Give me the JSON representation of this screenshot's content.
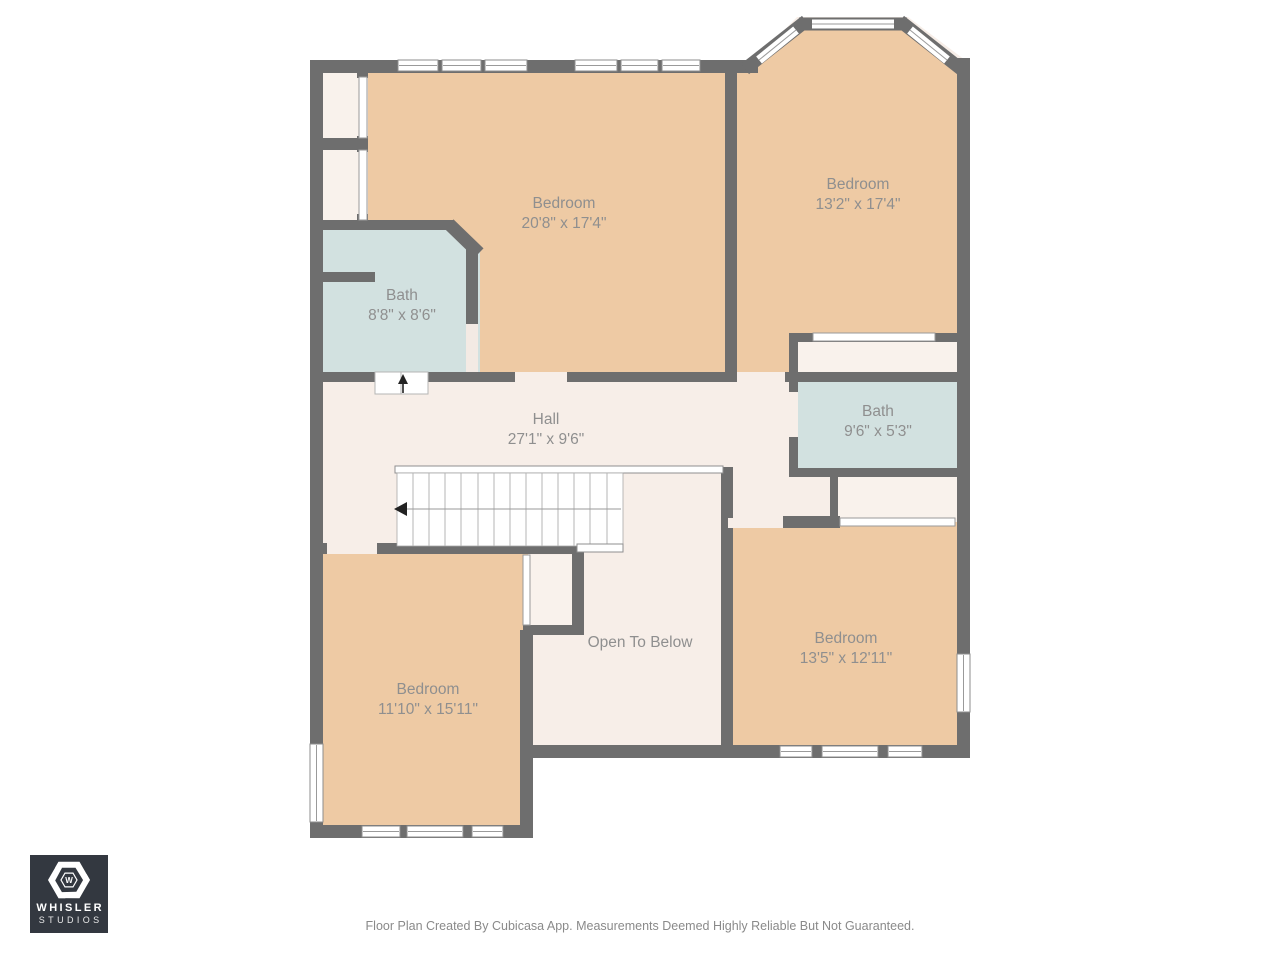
{
  "plan": {
    "rooms": [
      {
        "id": "bedroom-1",
        "label": "Bedroom",
        "dims": "20'8\" x 17'4\""
      },
      {
        "id": "bedroom-2",
        "label": "Bedroom",
        "dims": "13'2\" x 17'4\""
      },
      {
        "id": "bath-1",
        "label": "Bath",
        "dims": "8'8\" x 8'6\""
      },
      {
        "id": "hall",
        "label": "Hall",
        "dims": "27'1\" x 9'6\""
      },
      {
        "id": "bath-2",
        "label": "Bath",
        "dims": "9'6\" x 5'3\""
      },
      {
        "id": "open-to-below",
        "label": "Open To Below",
        "dims": ""
      },
      {
        "id": "bedroom-3",
        "label": "Bedroom",
        "dims": "13'5\" x 12'11\""
      },
      {
        "id": "bedroom-4",
        "label": "Bedroom",
        "dims": "11'10\" x 15'11\""
      }
    ],
    "colors": {
      "wall": "#6e6e6e",
      "bedroom_fill": "#eecaa4",
      "bath_fill": "#d2e1e0",
      "hall_fill": "#f7eee8",
      "closet_fill": "#f9f2ec",
      "label_text": "#8f8f8f"
    }
  },
  "logo": {
    "line1": "WHISLER",
    "line2": "STUDIOS",
    "monogram": "W"
  },
  "footer": {
    "text": "Floor Plan Created By Cubicasa App. Measurements Deemed Highly Reliable But Not Guaranteed."
  }
}
